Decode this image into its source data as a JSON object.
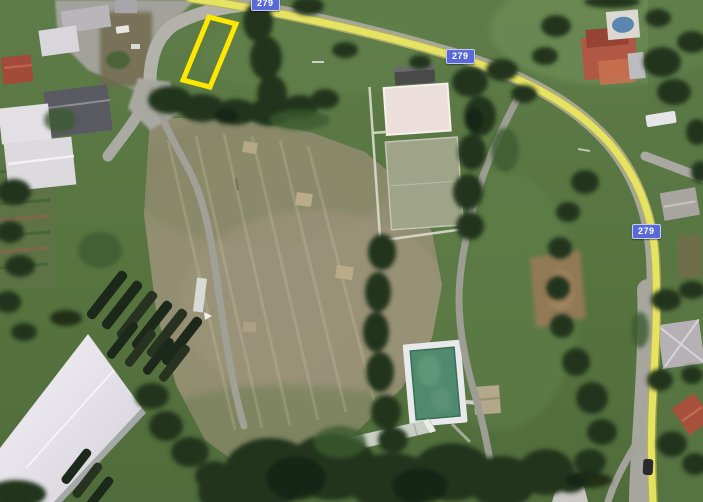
{
  "map": {
    "view_type": "satellite-aerial",
    "route_shields": [
      {
        "label": "279",
        "position": "top-edge"
      },
      {
        "label": "279",
        "position": "upper-middle-road"
      },
      {
        "label": "279",
        "position": "right-road"
      }
    ],
    "shield_style": {
      "bg": "#5b68d8",
      "border": "#c3cdf5",
      "text_color": "#ffffff"
    },
    "annotation": {
      "kind": "highlighted-parcel-outline",
      "points": "209,17 236,24 210,87 183,80",
      "stroke": "#ffe800",
      "stroke_width": 5
    },
    "palette": {
      "grass": "#597845",
      "lawn_light": "#6d8b54",
      "meadow": "#928e72",
      "trees_dark": "#22351d",
      "road_gray": "#a6a69e",
      "route_yellow": "#eae763",
      "route_yellow_border": "#b9b545",
      "pool_water": "#4f8a6e",
      "pool_deck": "#e9e9eb",
      "court_upper": "#ecdfdb",
      "court_lower": "#9fa489",
      "warehouse_roof": "#eceaf0",
      "red_roof": "#a5513c",
      "house_pool_blue": "#5b86b0"
    }
  }
}
